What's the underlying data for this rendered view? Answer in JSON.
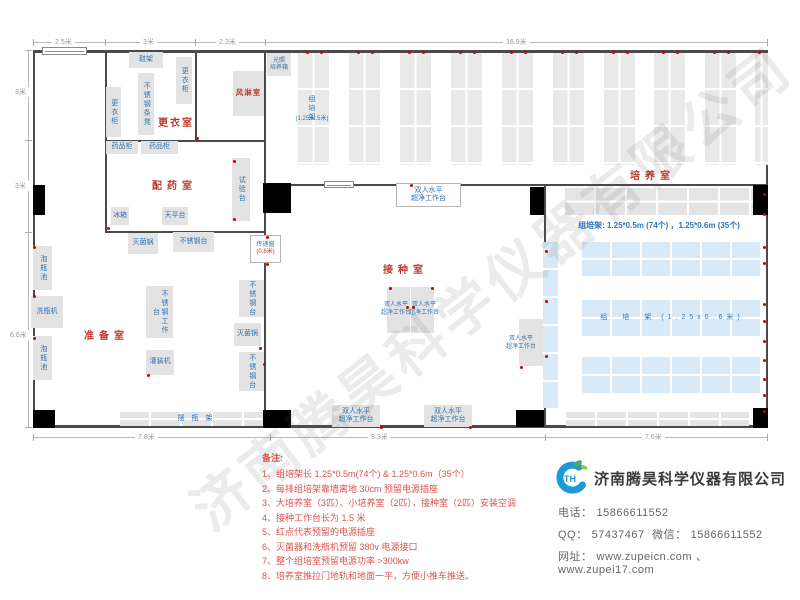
{
  "watermark": "济南腾昊科学仪器有限公司",
  "notes": {
    "title": "备注:",
    "items": [
      "1、组培架长 1.25*0.5m(74个) & 1.25*0.6m（35个）",
      "2、每排组培架靠墙离地 30cm 预留电源插座",
      "3、大培养室（3匹）、小培养室（2匹），接种室（2匹）安装空调",
      "4、接种工作台长为 1.5 米",
      "5、红点代表预留的电源插座",
      "6、灭菌器和洗瓶机预留 380v 电源接口",
      "7、整个组培室预留电源功率 >300kw",
      "8、培养室推拉门地轨和地面一平，方便小推车推送。"
    ]
  },
  "company": {
    "name": "济南腾昊科学仪器有限公司",
    "phone_label": "电话：",
    "phone": "15866611552",
    "qq_label": "QQ：",
    "qq": "57437467",
    "wechat_label": "微信：",
    "wechat": "15866611552",
    "web_label": "网址：",
    "website1": "www.zupeicn.com",
    "web_sep": "、",
    "website2": "www.zupei17.com"
  },
  "floorplan": {
    "accent_colors": {
      "wall": "#4a4a4a",
      "equipment_text": "#3273af",
      "room_label": "#bb3a30",
      "outlet_dot": "#cc0000",
      "rack_blue": "#d8eaf7"
    },
    "walls": [
      {
        "x": 33,
        "y": 50,
        "w": 735,
        "h": 3
      },
      {
        "x": 33,
        "y": 425,
        "w": 735,
        "h": 3
      },
      {
        "x": 33,
        "y": 50,
        "w": 2,
        "h": 378
      },
      {
        "x": 766,
        "y": 50,
        "w": 2,
        "h": 378
      },
      {
        "x": 105,
        "y": 50,
        "w": 1.5,
        "h": 182
      },
      {
        "x": 195,
        "y": 50,
        "w": 1.5,
        "h": 91
      },
      {
        "x": 105,
        "y": 140,
        "w": 160,
        "h": 1.5
      },
      {
        "x": 105,
        "y": 231,
        "w": 160,
        "h": 1.5
      },
      {
        "x": 264,
        "y": 50,
        "w": 1.5,
        "h": 378
      },
      {
        "x": 265,
        "y": 184,
        "w": 503,
        "h": 2
      },
      {
        "x": 544,
        "y": 184,
        "w": 1.5,
        "h": 244
      }
    ],
    "pillars": [
      {
        "x": 33,
        "y": 185,
        "w": 12,
        "h": 30
      },
      {
        "x": 33,
        "y": 410,
        "w": 22,
        "h": 18
      },
      {
        "x": 263,
        "y": 183,
        "w": 28,
        "h": 30
      },
      {
        "x": 263,
        "y": 410,
        "w": 28,
        "h": 18
      },
      {
        "x": 530,
        "y": 187,
        "w": 14,
        "h": 28
      },
      {
        "x": 516,
        "y": 410,
        "w": 28,
        "h": 17
      },
      {
        "x": 753,
        "y": 185,
        "w": 15,
        "h": 30
      },
      {
        "x": 753,
        "y": 408,
        "w": 15,
        "h": 20
      }
    ],
    "doors": [
      {
        "x": 42,
        "y": 47,
        "w": 45,
        "h": 8
      },
      {
        "x": 324,
        "y": 181,
        "w": 30,
        "h": 7
      }
    ],
    "shelf_columns": [
      {
        "x": 298,
        "y": 53,
        "w": 31,
        "h": 112
      },
      {
        "x": 349,
        "y": 53,
        "w": 31,
        "h": 112
      },
      {
        "x": 400,
        "y": 53,
        "w": 31,
        "h": 112
      },
      {
        "x": 451,
        "y": 53,
        "w": 31,
        "h": 112
      },
      {
        "x": 502,
        "y": 53,
        "w": 31,
        "h": 112
      },
      {
        "x": 553,
        "y": 53,
        "w": 31,
        "h": 112
      },
      {
        "x": 604,
        "y": 53,
        "w": 31,
        "h": 112
      },
      {
        "x": 654,
        "y": 53,
        "w": 31,
        "h": 112
      },
      {
        "x": 705,
        "y": 53,
        "w": 31,
        "h": 112
      },
      {
        "x": 755,
        "y": 53,
        "w": 13,
        "h": 112
      }
    ],
    "gray_shelves": [
      {
        "name": "culture-shelf-top",
        "x": 565,
        "y": 188,
        "w": 188,
        "h": 27
      },
      {
        "name": "culture-shelf-bottom",
        "x": 566,
        "y": 412,
        "w": 183,
        "h": 14
      },
      {
        "name": "bottle-rack-shelf",
        "x": 120,
        "y": 412,
        "w": 147,
        "h": 14
      }
    ],
    "blue_shelves": [
      {
        "name": "blue-rack-row-1",
        "x": 582,
        "y": 242,
        "w": 180,
        "h": 34
      },
      {
        "name": "blue-rack-row-2",
        "x": 582,
        "y": 300,
        "w": 180,
        "h": 36
      },
      {
        "name": "blue-rack-row-3",
        "x": 582,
        "y": 357,
        "w": 180,
        "h": 36
      }
    ],
    "blue_strips": [
      {
        "name": "blue-rack-strip",
        "x": 543,
        "y": 242,
        "w": 15,
        "h": 166
      }
    ],
    "equipment": [
      {
        "name": "shoe-rack",
        "label": "鞋架",
        "x": 129,
        "y": 52,
        "w": 34,
        "h": 16
      },
      {
        "name": "locker-cabinet-right",
        "label": "更衣柜",
        "x": 176,
        "y": 57,
        "w": 16,
        "h": 47,
        "v": 1
      },
      {
        "name": "steel-strip-bench",
        "label": "不锈钢条凳",
        "x": 138,
        "y": 73,
        "w": 16,
        "h": 62,
        "v": 1
      },
      {
        "name": "locker-cabinet-left",
        "label": "更衣柜",
        "x": 106,
        "y": 87,
        "w": 15,
        "h": 50,
        "v": 1
      },
      {
        "name": "air-shower",
        "label": "风淋室",
        "x": 233,
        "y": 71,
        "w": 31,
        "h": 45,
        "cls": "red"
      },
      {
        "name": "light-incubator",
        "label": "光照\n培养箱",
        "x": 267,
        "y": 53,
        "w": 24,
        "h": 23,
        "cls": "t6"
      },
      {
        "name": "medicine-cabinet-1",
        "label": "药品柜",
        "x": 106,
        "y": 141,
        "w": 32,
        "h": 13
      },
      {
        "name": "medicine-cabinet-2",
        "label": "药品柜",
        "x": 141,
        "y": 141,
        "w": 37,
        "h": 13
      },
      {
        "name": "test-bench",
        "label": "试验台",
        "x": 232,
        "y": 158,
        "w": 18,
        "h": 63,
        "v": 1
      },
      {
        "name": "fridge",
        "label": "冰箱",
        "x": 111,
        "y": 207,
        "w": 18,
        "h": 18
      },
      {
        "name": "balance-table",
        "label": "天平台",
        "x": 162,
        "y": 207,
        "w": 26,
        "h": 18
      },
      {
        "name": "sterilizer-1",
        "label": "灭菌锅",
        "x": 128,
        "y": 233,
        "w": 30,
        "h": 21
      },
      {
        "name": "steel-table-1",
        "label": "不锈钢台",
        "x": 173,
        "y": 232,
        "w": 41,
        "h": 20
      },
      {
        "name": "soak-pool-1",
        "label": "泡瓶池",
        "x": 33,
        "y": 246,
        "w": 19,
        "h": 44,
        "v": 1
      },
      {
        "name": "bottle-washer",
        "label": "洗瓶机",
        "x": 31,
        "y": 296,
        "w": 32,
        "h": 32
      },
      {
        "name": "soak-pool-2",
        "label": "泡瓶池",
        "x": 33,
        "y": 336,
        "w": 19,
        "h": 44,
        "v": 1
      },
      {
        "name": "steel-worktable",
        "label": "不锈钢工作台",
        "x": 146,
        "y": 286,
        "w": 27,
        "h": 52,
        "v": 1
      },
      {
        "name": "filling-machine",
        "label": "灌装机",
        "x": 146,
        "y": 350,
        "w": 28,
        "h": 25
      },
      {
        "name": "steel-table-2",
        "label": "不锈钢台",
        "x": 239,
        "y": 280,
        "w": 25,
        "h": 37,
        "v": 1
      },
      {
        "name": "sterilizer-2",
        "label": "灭菌锅",
        "x": 234,
        "y": 323,
        "w": 27,
        "h": 23
      },
      {
        "name": "steel-table-3",
        "label": "不锈钢台",
        "x": 239,
        "y": 352,
        "w": 25,
        "h": 39,
        "v": 1
      },
      {
        "name": "pass-window",
        "label": "传递窗",
        "sub": "(0.6米)",
        "x": 250,
        "y": 235,
        "w": 31,
        "h": 28,
        "cls": "lightbox t6"
      },
      {
        "name": "clean-bench-top",
        "label": "双人水平\n超净工作台",
        "x": 396,
        "y": 183,
        "w": 65,
        "h": 24,
        "cls": "lightbox"
      },
      {
        "name": "clean-bench-center-1",
        "label": "",
        "x": 387,
        "y": 287,
        "w": 23,
        "h": 46
      },
      {
        "name": "clean-bench-center-2",
        "label": "",
        "x": 411,
        "y": 287,
        "w": 23,
        "h": 46
      },
      {
        "name": "clean-bench-right",
        "label": "",
        "x": 519,
        "y": 319,
        "w": 24,
        "h": 47
      },
      {
        "name": "clean-bench-bottom-1",
        "label": "双人水平\n超净工作台",
        "x": 332,
        "y": 405,
        "w": 48,
        "h": 22
      },
      {
        "name": "clean-bench-bottom-2",
        "label": "双人水平\n超净工作台",
        "x": 424,
        "y": 405,
        "w": 48,
        "h": 22
      }
    ],
    "room_labels": [
      {
        "name": "room-label-dressing",
        "label": "更衣室",
        "x": 158,
        "y": 114,
        "cls": "tight"
      },
      {
        "name": "room-label-dispensing",
        "label": "配药室",
        "x": 152,
        "y": 177
      },
      {
        "name": "room-label-prep",
        "label": "准备室",
        "x": 84,
        "y": 327
      },
      {
        "name": "room-label-inoculation",
        "label": "接种室",
        "x": 383,
        "y": 261
      },
      {
        "name": "room-label-culture",
        "label": "培养室",
        "x": 630,
        "y": 167
      }
    ],
    "texts": [
      {
        "name": "rack-column-label",
        "label": "组培架",
        "x": 304,
        "y": 90,
        "w": 14,
        "h": 36,
        "v": 1
      },
      {
        "name": "rack-column-size",
        "label": "(1.25x0.5米)",
        "x": 286,
        "y": 114,
        "w": 52,
        "h": 10,
        "cls": "t6"
      },
      {
        "name": "rack-spec-line",
        "label": "组培架: 1.25*0.5m (74个) ，1.25*0.6m (35个)",
        "x": 552,
        "y": 219,
        "w": 214,
        "h": 13,
        "cls": "t8"
      },
      {
        "name": "blue-rack-label",
        "label": "组　培　架  (1.25x0.6米)",
        "x": 592,
        "y": 311,
        "w": 160,
        "h": 13,
        "cls": "spread"
      },
      {
        "name": "bench-center-1-label",
        "label": "双人水平\n超净工作台",
        "x": 373,
        "y": 299,
        "w": 46,
        "h": 20,
        "cls": "t6"
      },
      {
        "name": "bench-center-2-label",
        "label": "双人水平\n超净工作台",
        "x": 401,
        "y": 299,
        "w": 46,
        "h": 20,
        "cls": "t6"
      },
      {
        "name": "bench-right-label",
        "label": "双人水平\n超净工作台",
        "x": 499,
        "y": 333,
        "w": 44,
        "h": 20,
        "cls": "t6"
      },
      {
        "name": "bottle-rack-label",
        "label": "摆　瓶　架",
        "x": 155,
        "y": 413,
        "w": 80,
        "h": 12
      }
    ],
    "dots": [
      [
        306,
        51
      ],
      [
        320,
        51
      ],
      [
        357,
        51
      ],
      [
        371,
        51
      ],
      [
        408,
        51
      ],
      [
        422,
        51
      ],
      [
        459,
        51
      ],
      [
        473,
        51
      ],
      [
        510,
        51
      ],
      [
        524,
        51
      ],
      [
        561,
        51
      ],
      [
        575,
        51
      ],
      [
        612,
        51
      ],
      [
        626,
        51
      ],
      [
        662,
        51
      ],
      [
        676,
        51
      ],
      [
        713,
        51
      ],
      [
        727,
        51
      ],
      [
        758,
        51
      ],
      [
        763,
        193
      ],
      [
        763,
        213
      ],
      [
        763,
        246
      ],
      [
        763,
        262
      ],
      [
        763,
        303
      ],
      [
        763,
        320
      ],
      [
        763,
        340
      ],
      [
        763,
        359
      ],
      [
        763,
        378
      ],
      [
        763,
        394
      ],
      [
        763,
        410
      ],
      [
        33,
        246
      ],
      [
        33,
        295
      ],
      [
        33,
        337
      ],
      [
        107,
        227
      ],
      [
        233,
        160
      ],
      [
        233,
        218
      ],
      [
        196,
        137
      ],
      [
        266,
        236
      ],
      [
        266,
        263
      ],
      [
        147,
        374
      ],
      [
        259,
        347
      ],
      [
        263,
        363
      ],
      [
        389,
        287
      ],
      [
        431,
        287
      ],
      [
        406,
        306
      ],
      [
        412,
        306
      ],
      [
        410,
        184
      ],
      [
        520,
        366
      ],
      [
        380,
        426
      ],
      [
        469,
        426
      ],
      [
        545,
        250
      ],
      [
        545,
        300
      ],
      [
        545,
        355
      ]
    ],
    "dim_lines": [
      {
        "x": 33,
        "y": 42,
        "w": 735,
        "h": 1
      },
      {
        "x": 28,
        "y": 50,
        "w": 1,
        "h": 378
      },
      {
        "x": 33,
        "y": 437,
        "w": 735,
        "h": 1
      }
    ],
    "dim_ticks": [
      {
        "x": 33,
        "y": 39,
        "o": "v"
      },
      {
        "x": 105,
        "y": 39,
        "o": "v"
      },
      {
        "x": 195,
        "y": 39,
        "o": "v"
      },
      {
        "x": 265,
        "y": 39,
        "o": "v"
      },
      {
        "x": 767,
        "y": 39,
        "o": "v"
      },
      {
        "x": 25,
        "y": 50,
        "o": "h"
      },
      {
        "x": 25,
        "y": 140,
        "o": "h"
      },
      {
        "x": 25,
        "y": 232,
        "o": "h"
      },
      {
        "x": 25,
        "y": 427,
        "o": "h"
      },
      {
        "x": 33,
        "y": 434,
        "o": "v"
      },
      {
        "x": 270,
        "y": 434,
        "o": "v"
      },
      {
        "x": 545,
        "y": 434,
        "o": "v"
      },
      {
        "x": 767,
        "y": 434,
        "o": "v"
      }
    ],
    "dim_labels": [
      {
        "label": "2.5米",
        "x": 52,
        "y": 37
      },
      {
        "label": "3米",
        "x": 140,
        "y": 37
      },
      {
        "label": "2.3米",
        "x": 216,
        "y": 37
      },
      {
        "label": "16.9米",
        "x": 503,
        "y": 37
      },
      {
        "label": "3米",
        "x": 12,
        "y": 87
      },
      {
        "label": "3米",
        "x": 12,
        "y": 181
      },
      {
        "label": "6.6米",
        "x": 7,
        "y": 330
      },
      {
        "label": "7.8米",
        "x": 135,
        "y": 432
      },
      {
        "label": "9.3米",
        "x": 368,
        "y": 432
      },
      {
        "label": "7.6米",
        "x": 642,
        "y": 432
      }
    ]
  }
}
